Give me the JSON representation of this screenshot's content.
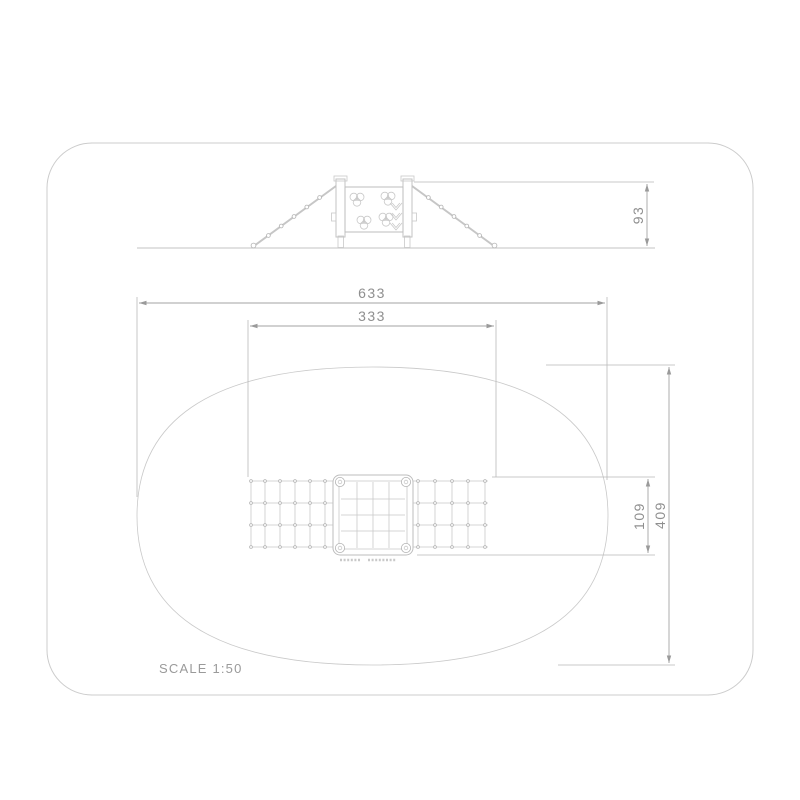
{
  "document": {
    "type": "technical drawing",
    "scale_label": "SCALE 1:50"
  },
  "colors": {
    "background": "#ffffff",
    "page_border": "#cccccc",
    "drawing_line": "#c3c3c3",
    "dimension_line": "#a3a3a3",
    "dimension_text": "#8f8f8f"
  },
  "elevation_view": {
    "dimensions": {
      "height": "93"
    }
  },
  "plan_view": {
    "dimensions": {
      "overall_width": "633",
      "inner_width": "333",
      "net_depth": "109",
      "overall_depth": "409"
    }
  }
}
